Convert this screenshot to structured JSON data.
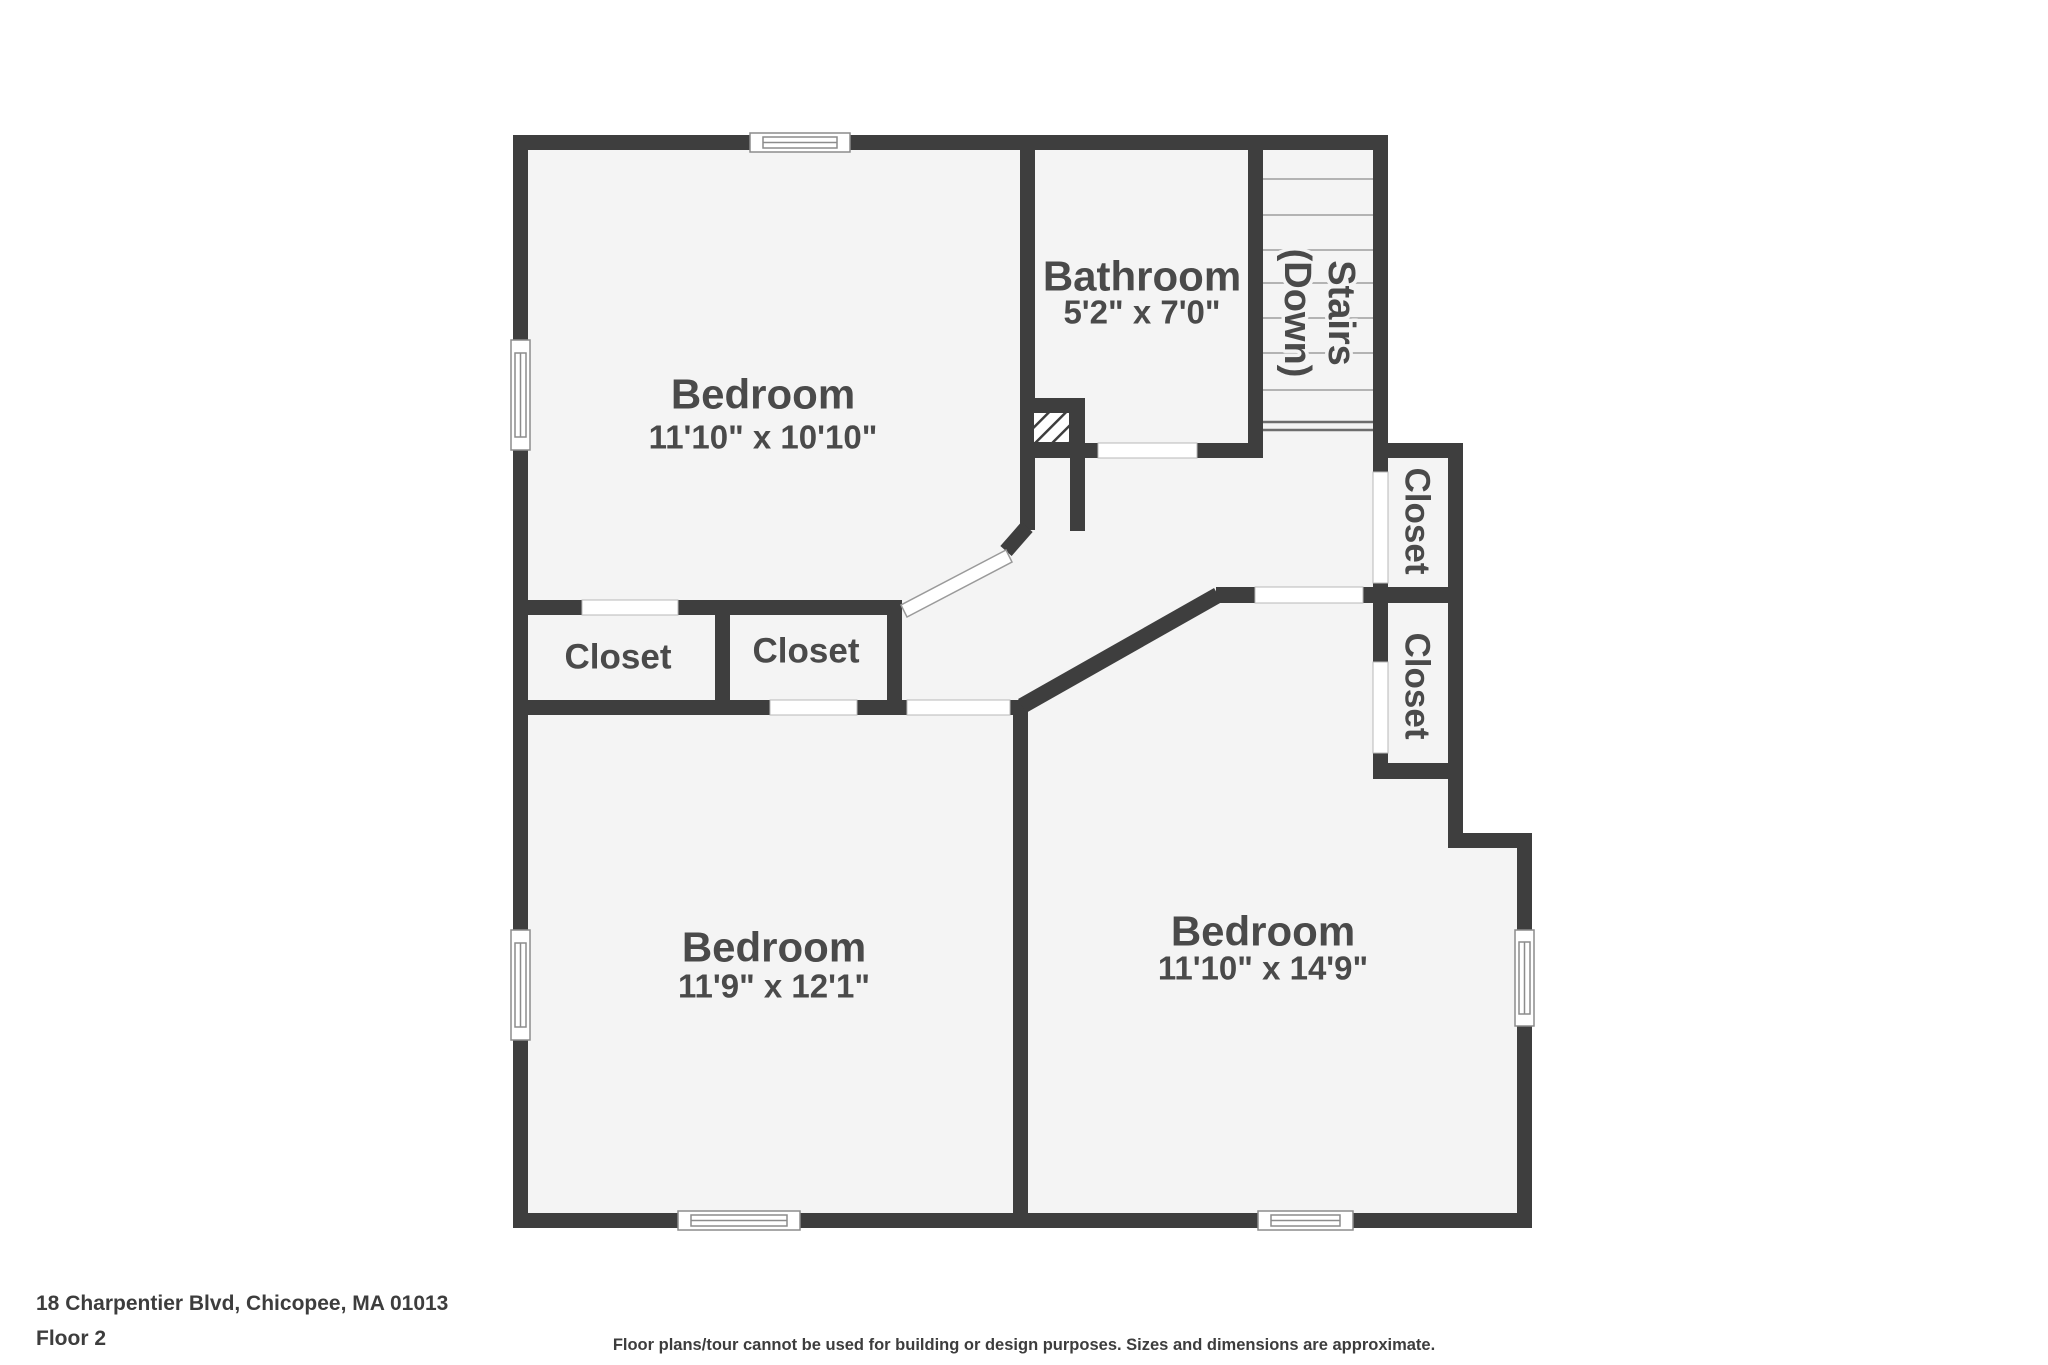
{
  "plan": {
    "rooms": {
      "bedroom_top_left": {
        "name": "Bedroom",
        "dims": "11'10\" x 10'10\""
      },
      "bathroom": {
        "name": "Bathroom",
        "dims": "5'2\" x 7'0\""
      },
      "bedroom_bottom_left": {
        "name": "Bedroom",
        "dims": "11'9\" x 12'1\""
      },
      "bedroom_bottom_right": {
        "name": "Bedroom",
        "dims": "11'10\" x 14'9\""
      },
      "stairs": {
        "line1": "Stairs",
        "line2": "(Down)"
      },
      "closet_mid_left": {
        "name": "Closet"
      },
      "closet_mid_right": {
        "name": "Closet"
      },
      "closet_right_upper": {
        "name": "Closet"
      },
      "closet_right_lower": {
        "name": "Closet"
      }
    }
  },
  "footer": {
    "address": "18 Charpentier Blvd, Chicopee, MA 01013",
    "floor": "Floor 2",
    "disclaimer": "Floor plans/tour cannot be used for building or design purposes. Sizes and dimensions are approximate."
  },
  "colors": {
    "wall": "#3e3e3e",
    "floor": "#f4f4f4",
    "label": "#4a4a4a"
  }
}
